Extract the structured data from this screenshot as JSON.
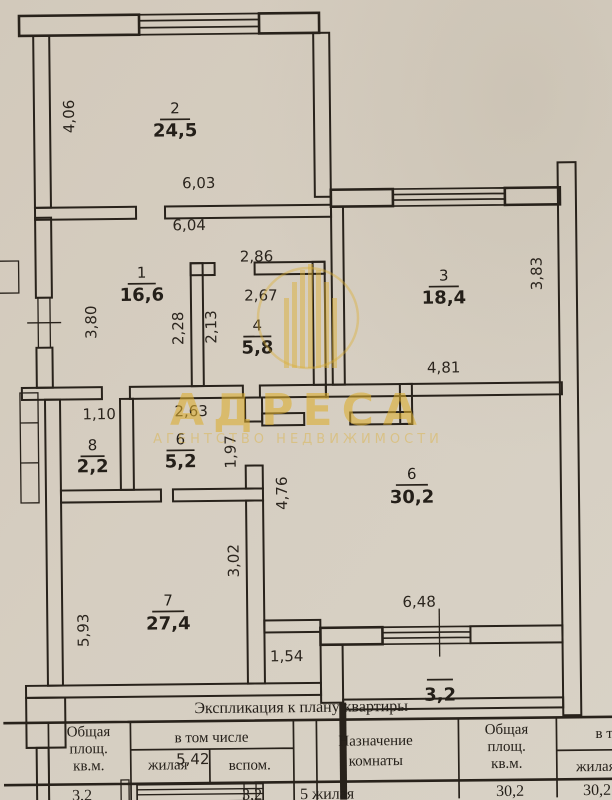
{
  "document": {
    "kind": "apartment floor plan scan",
    "colors": {
      "paper": "#d5cdc0",
      "ink": "#28221b",
      "watermark": "#dcae2f"
    }
  },
  "watermark": {
    "brand": "АДРЕСА",
    "tagline": "АГЕНТСТВО НЕДВИЖИМОСТИ"
  },
  "plan": {
    "rooms": [
      {
        "n": "2",
        "a": "24,5"
      },
      {
        "n": "1",
        "a": "16,6"
      },
      {
        "n": "4",
        "a": "5,8"
      },
      {
        "n": "3",
        "a": "18,4"
      },
      {
        "n": "8",
        "a": "2,2"
      },
      {
        "n": "6",
        "a": "5,2"
      },
      {
        "n": "6",
        "a": "30,2"
      },
      {
        "n": "7",
        "a": "27,4"
      },
      {
        "n": "",
        "a": "3,2"
      }
    ],
    "dims": [
      "4,06",
      "6,03",
      "6,04",
      "2,86",
      "2,67",
      "3,80",
      "2,28",
      "2,13",
      "3,83",
      "4,81",
      "1,10",
      "2,63",
      "1,97",
      "4,76",
      "3,02",
      "5,93",
      "1,54",
      "6,48",
      "5,42"
    ]
  },
  "table": {
    "title": "Экспликация к плану квартиры",
    "col_total": [
      "Общая",
      "площ.",
      "кв.м."
    ],
    "col_incl": "в том числе",
    "col_living": "жилая",
    "col_aux": "вспом.",
    "col_purpose": [
      "Назначение",
      "комнаты"
    ],
    "col_total2": [
      "Общая",
      "площ.",
      "кв.м."
    ],
    "col_incl2": "в т",
    "col_living2": "жилая",
    "row": {
      "total": "3,2",
      "aux": "3,2",
      "purpose": "5 жилая",
      "total2": "30,2",
      "living2": "30,2"
    }
  }
}
